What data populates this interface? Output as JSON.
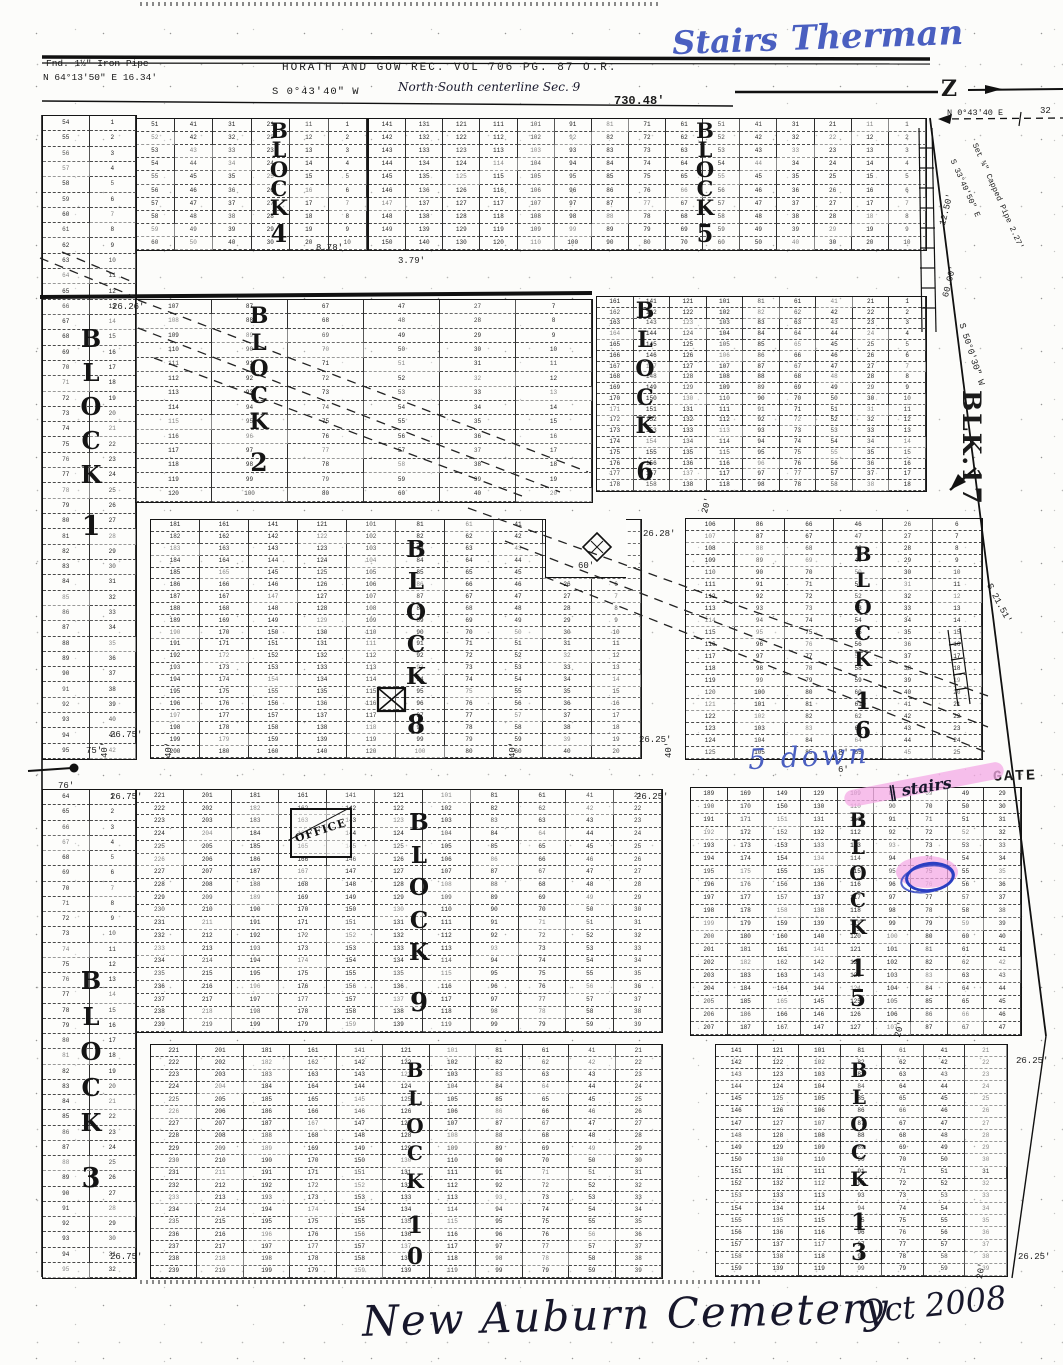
{
  "title_note": "Scanned plat map, New Auburn Cemetery, Oct 2008",
  "survey": {
    "fnd_pipe_line1": "Fnd. 1½\" Iron Pipe",
    "fnd_pipe_line2": "N 64°13'50\" E  16.34'",
    "record_title": "HORATH  AND  GOW    REC. VOL 706  PG. 87  O.R.",
    "bearing_west": "S 0°43'40\" W",
    "centerline": "North·South centerline Sec. 9",
    "distance": "730.48'",
    "north_arrow": "Z",
    "ne_bearing": "N 0°43'40 E",
    "ne_distance": "32",
    "set_pipe": "Set ¾\" Capped Pipe 2.27'",
    "se_bearing": "S 33°49'50\" E",
    "d1250": "12.50'",
    "d6000": "60.00'",
    "s5030": "S 50°0'30\" W",
    "blk17": "BLK.17",
    "s2151": "S 21.51'"
  },
  "annotations": {
    "stairs_word": "Stairs",
    "therman_word": "Therman",
    "five_down": "5 down",
    "stairs_note": "‖ stairs",
    "gate": "GATE",
    "office": "OFFICE",
    "cemetery_name": "New Auburn Cemetery",
    "date_note": "Oct 2008"
  },
  "dimensions": [
    {
      "t": "8.78'",
      "x": 316,
      "y": 243,
      "r": 0
    },
    {
      "t": "3.79'",
      "x": 398,
      "y": 256,
      "r": 0
    },
    {
      "t": "26.26'",
      "x": 112,
      "y": 302,
      "r": 0
    },
    {
      "t": "26.28'",
      "x": 643,
      "y": 529,
      "r": 0
    },
    {
      "t": "26.25'",
      "x": 639,
      "y": 735,
      "r": 0
    },
    {
      "t": "26.75'",
      "x": 110,
      "y": 730,
      "r": 0
    },
    {
      "t": "75'",
      "x": 86,
      "y": 746,
      "r": 0
    },
    {
      "t": "76'",
      "x": 58,
      "y": 781,
      "r": 0
    },
    {
      "t": "26.75'",
      "x": 110,
      "y": 792,
      "r": 0
    },
    {
      "t": "26.25'",
      "x": 636,
      "y": 792,
      "r": 0
    },
    {
      "t": "40'",
      "x": 100,
      "y": 758,
      "r": -90
    },
    {
      "t": "40'",
      "x": 164,
      "y": 758,
      "r": -90
    },
    {
      "t": "40'",
      "x": 508,
      "y": 758,
      "r": -90
    },
    {
      "t": "40'",
      "x": 664,
      "y": 758,
      "r": -90
    },
    {
      "t": "20'",
      "x": 700,
      "y": 512,
      "r": -75
    },
    {
      "t": "20'",
      "x": 893,
      "y": 1036,
      "r": -75
    },
    {
      "t": "20'",
      "x": 975,
      "y": 1278,
      "r": -80
    },
    {
      "t": "60'",
      "x": 578,
      "y": 561,
      "r": 0
    },
    {
      "t": "8'",
      "x": 838,
      "y": 748,
      "r": 0
    },
    {
      "t": "6'",
      "x": 838,
      "y": 765,
      "r": 0
    },
    {
      "t": "26.75'",
      "x": 110,
      "y": 1252,
      "r": 0
    },
    {
      "t": "26.25'",
      "x": 1018,
      "y": 1252,
      "r": 0
    },
    {
      "t": "26.25'",
      "x": 1016,
      "y": 1056,
      "r": 0
    },
    {
      "t": "12.50'",
      "x": 938,
      "y": 224,
      "r": -76
    },
    {
      "t": "60.00'",
      "x": 941,
      "y": 296,
      "r": -76
    }
  ],
  "map_data": {
    "blocks": [
      {
        "name": "block-4",
        "word": "BLOCK",
        "num": "4",
        "x": 135,
        "y": 118,
        "w": 231,
        "h": 131,
        "rows": 10,
        "colStarts": [
          51,
          41,
          31,
          21,
          11,
          1
        ],
        "labelX": 268,
        "labelY": 121,
        "labelH": 124,
        "fs": 21
      },
      {
        "name": "block-5",
        "word": "BLOCK",
        "num": "5",
        "x": 368,
        "y": 118,
        "w": 557,
        "h": 131,
        "rows": 10,
        "colStarts": [
          141,
          131,
          121,
          111,
          101,
          91,
          81,
          71,
          61,
          51,
          41,
          31,
          21,
          11,
          1
        ],
        "labelX": 694,
        "labelY": 121,
        "labelH": 124,
        "fs": 21
      },
      {
        "name": "block-1",
        "word": "BLOCK",
        "num": "1",
        "x": 42,
        "y": 115,
        "w": 93,
        "h": 643,
        "rows": 42,
        "colStarts": [
          54,
          1
        ],
        "labelX": 80,
        "labelY": 328,
        "labelH": 212,
        "fs": 24
      },
      {
        "name": "block-2",
        "word": "BLOCK",
        "num": "2",
        "x": 135,
        "y": 299,
        "w": 456,
        "h": 202,
        "rows": 14,
        "colStarts": [
          107,
          87,
          67,
          47,
          27,
          7
        ],
        "labelX": 248,
        "labelY": 306,
        "labelH": 168,
        "fs": 22
      },
      {
        "name": "block-6",
        "word": "BLOCK",
        "num": "6",
        "x": 596,
        "y": 296,
        "w": 329,
        "h": 194,
        "rows": 18,
        "colStarts": [
          161,
          141,
          121,
          101,
          81,
          61,
          41,
          21,
          1
        ],
        "labelX": 634,
        "labelY": 301,
        "labelH": 182,
        "fs": 22
      },
      {
        "name": "block-8",
        "word": "BLOCK",
        "num": "8",
        "x": 150,
        "y": 519,
        "w": 490,
        "h": 238,
        "rows": 20,
        "colStarts": [
          181,
          161,
          141,
          121,
          101,
          81,
          61,
          41,
          21,
          1
        ],
        "labelX": 405,
        "labelY": 539,
        "labelH": 199,
        "fs": 23
      },
      {
        "name": "block-16",
        "word": "BLOCK",
        "num": "16",
        "x": 685,
        "y": 518,
        "w": 296,
        "h": 240,
        "rows": 20,
        "colStarts": [
          106,
          86,
          66,
          46,
          26,
          6
        ],
        "labelX": 852,
        "labelY": 545,
        "labelH": 196,
        "fs": 20
      },
      {
        "name": "block-9",
        "word": "BLOCK",
        "num": "9",
        "x": 135,
        "y": 789,
        "w": 526,
        "h": 242,
        "rows": 19,
        "colStarts": [
          221,
          201,
          181,
          161,
          141,
          121,
          101,
          81,
          61,
          41,
          21
        ],
        "labelX": 408,
        "labelY": 812,
        "labelH": 204,
        "fs": 23
      },
      {
        "name": "block-15",
        "word": "BLOCK",
        "num": "15",
        "x": 690,
        "y": 787,
        "w": 330,
        "h": 247,
        "rows": 19,
        "colStarts": [
          189,
          169,
          149,
          129,
          109,
          89,
          69,
          49,
          29
        ],
        "labelX": 847,
        "labelY": 811,
        "labelH": 198,
        "fs": 20
      },
      {
        "name": "block-3",
        "word": "BLOCK",
        "num": "3",
        "x": 42,
        "y": 789,
        "w": 93,
        "h": 488,
        "rows": 32,
        "colStarts": [
          64,
          1
        ],
        "labelX": 80,
        "labelY": 970,
        "labelH": 222,
        "fs": 24
      },
      {
        "name": "block-10",
        "word": "BLOCK",
        "num": "10",
        "x": 150,
        "y": 1044,
        "w": 511,
        "h": 233,
        "rows": 19,
        "colStarts": [
          221,
          201,
          181,
          161,
          141,
          121,
          101,
          81,
          61,
          41,
          21
        ],
        "labelX": 404,
        "labelY": 1061,
        "labelH": 206,
        "fs": 20
      },
      {
        "name": "block-13",
        "word": "BLOCK",
        "num": "13",
        "x": 715,
        "y": 1044,
        "w": 291,
        "h": 231,
        "rows": 19,
        "colStarts": [
          141,
          121,
          101,
          81,
          61,
          41,
          21
        ],
        "labelX": 848,
        "labelY": 1061,
        "labelH": 202,
        "fs": 20
      }
    ]
  }
}
